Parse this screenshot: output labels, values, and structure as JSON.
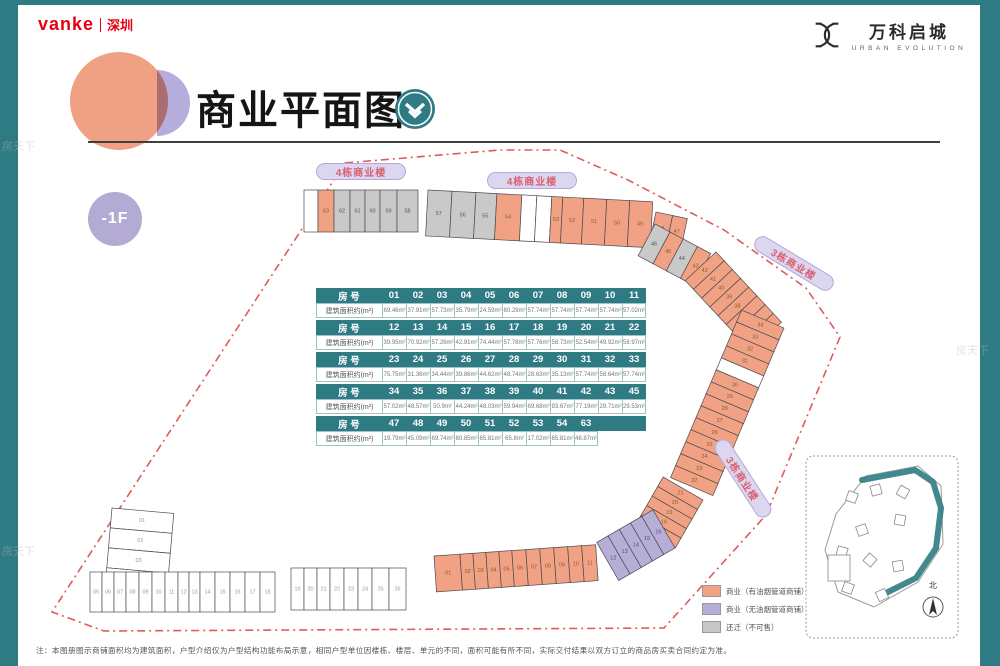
{
  "brand": {
    "name": "vanke",
    "region": "深圳"
  },
  "logo": {
    "title": "万科启城",
    "subtitle": "URBAN EVOLUTION"
  },
  "title": {
    "text": "商业平面图"
  },
  "floor_badge": "-1F",
  "watermark": "房天下",
  "building_labels": {
    "b4": "4栋商业楼",
    "b3": "3栋商业楼"
  },
  "table": {
    "no_label": "房  号",
    "area_label": "建筑面积约(m²)",
    "groups": [
      {
        "nos": [
          "01",
          "02",
          "03",
          "04",
          "05",
          "06",
          "07",
          "08",
          "09",
          "10",
          "11"
        ],
        "areas": [
          "69.46m²",
          "37.91m²",
          "57.73m²",
          "35.79m²",
          "24.59m²",
          "60.29m²",
          "57.74m²",
          "57.74m²",
          "57.74m²",
          "57.74m²",
          "57.02m²"
        ]
      },
      {
        "nos": [
          "12",
          "13",
          "14",
          "15",
          "16",
          "17",
          "18",
          "19",
          "20",
          "21",
          "22"
        ],
        "areas": [
          "39.95m²",
          "70.92m²",
          "57.26m²",
          "42.91m²",
          "74.44m²",
          "57.78m²",
          "57.76m²",
          "58.73m²",
          "52.54m²",
          "49.92m²",
          "58.97m²"
        ]
      },
      {
        "nos": [
          "23",
          "24",
          "25",
          "26",
          "27",
          "28",
          "29",
          "30",
          "31",
          "32",
          "33"
        ],
        "areas": [
          "75.75m²",
          "31.36m²",
          "34.44m²",
          "39.86m²",
          "44.62m²",
          "48.74m²",
          "28.63m²",
          "35.13m²",
          "57.74m²",
          "58.64m²",
          "57.74m²"
        ]
      },
      {
        "nos": [
          "34",
          "35",
          "36",
          "37",
          "38",
          "39",
          "40",
          "41",
          "42",
          "43",
          "45"
        ],
        "areas": [
          "57.02m²",
          "48.57m²",
          "50.9m²",
          "44.24m²",
          "48.03m²",
          "59.94m²",
          "69.68m²",
          "93.67m²",
          "77.19m²",
          "29.71m²",
          "29.53m²"
        ]
      },
      {
        "nos": [
          "47",
          "48",
          "49",
          "50",
          "51",
          "52",
          "53",
          "54",
          "63"
        ],
        "areas": [
          "19.79m²",
          "45.09m²",
          "69.74m²",
          "80.85m²",
          "65.81m²",
          "65.8m²",
          "17.02m²",
          "65.81m²",
          "48.87m²"
        ]
      }
    ]
  },
  "legend": {
    "items": [
      {
        "label": "商业（有油烟管道商铺）",
        "color": "#f2a284"
      },
      {
        "label": "商业（无油烟管道商铺）",
        "color": "#b7aed8"
      },
      {
        "label": "还迁（不可售）",
        "color": "#c7c7c7"
      }
    ]
  },
  "unit_colors": {
    "orange": "#f2a284",
    "gray": "#c9c9c9",
    "purple": "#b7aed8",
    "white": "#ffffff"
  },
  "boundary_color": "#e05a5a",
  "accent_teal": "#2e7b83",
  "inset": {
    "north_label": "北"
  },
  "note": "注：本图册图示商铺面积均为建筑面积，户型介绍仅为户型结构功能布局示意，相同户型单位因楼栋、楼层、单元的不同，面积可能有所不同，实际交付结果以双方订立的商品房买卖合同约定为准。",
  "plan": {
    "strips": {
      "topLeftRow": [
        {
          "no": "",
          "cat": "white"
        },
        {
          "no": "63",
          "cat": "orange"
        },
        {
          "no": "62",
          "cat": "gray"
        },
        {
          "no": "61",
          "cat": "gray"
        },
        {
          "no": "60",
          "cat": "gray"
        },
        {
          "no": "59",
          "cat": "gray"
        },
        {
          "no": "58",
          "cat": "gray"
        }
      ],
      "topMidRow": [
        {
          "no": "57",
          "cat": "gray"
        },
        {
          "no": "56",
          "cat": "gray"
        },
        {
          "no": "55",
          "cat": "gray"
        },
        {
          "no": "54",
          "cat": "orange"
        },
        {
          "no": "",
          "cat": "white"
        },
        {
          "no": "",
          "cat": "white"
        },
        {
          "no": "53",
          "cat": "orange"
        },
        {
          "no": "52",
          "cat": "orange"
        },
        {
          "no": "51",
          "cat": "orange"
        },
        {
          "no": "50",
          "cat": "orange"
        },
        {
          "no": "49",
          "cat": "orange"
        }
      ],
      "topMidRow2": [
        {
          "no": "48",
          "cat": "orange"
        },
        {
          "no": "47",
          "cat": "orange"
        }
      ],
      "rightDiag1": [
        {
          "no": "46",
          "cat": "gray"
        },
        {
          "no": "45",
          "cat": "orange"
        },
        {
          "no": "44",
          "cat": "gray"
        },
        {
          "no": "43",
          "cat": "orange"
        }
      ],
      "rightDiag2": [
        {
          "no": "42",
          "cat": "orange"
        },
        {
          "no": "41",
          "cat": "orange"
        },
        {
          "no": "40",
          "cat": "orange"
        },
        {
          "no": "39",
          "cat": "orange"
        },
        {
          "no": "38",
          "cat": "orange"
        },
        {
          "no": "37",
          "cat": "orange"
        },
        {
          "no": "36",
          "cat": "orange"
        },
        {
          "no": "35",
          "cat": "orange"
        }
      ],
      "rightCol": [
        {
          "no": "34",
          "cat": "orange"
        },
        {
          "no": "33",
          "cat": "orange"
        },
        {
          "no": "32",
          "cat": "orange"
        },
        {
          "no": "31",
          "cat": "orange"
        },
        {
          "no": "",
          "cat": "white"
        },
        {
          "no": "30",
          "cat": "orange"
        },
        {
          "no": "29",
          "cat": "orange"
        },
        {
          "no": "28",
          "cat": "orange"
        },
        {
          "no": "27",
          "cat": "orange"
        },
        {
          "no": "26",
          "cat": "orange"
        },
        {
          "no": "25",
          "cat": "orange"
        },
        {
          "no": "24",
          "cat": "orange"
        },
        {
          "no": "23",
          "cat": "orange"
        },
        {
          "no": "22",
          "cat": "orange"
        }
      ],
      "bottomRightAsc": [
        {
          "no": "21",
          "cat": "orange"
        },
        {
          "no": "20",
          "cat": "orange"
        },
        {
          "no": "19",
          "cat": "orange"
        },
        {
          "no": "18",
          "cat": "orange"
        },
        {
          "no": "17",
          "cat": "orange"
        }
      ],
      "purpleCurve": [
        {
          "no": "16",
          "cat": "purple"
        },
        {
          "no": "15",
          "cat": "purple"
        },
        {
          "no": "14",
          "cat": "purple"
        },
        {
          "no": "13",
          "cat": "purple"
        },
        {
          "no": "12",
          "cat": "purple"
        }
      ],
      "bottomMidRow": [
        {
          "no": "01",
          "cat": "orange"
        },
        {
          "no": "02",
          "cat": "orange"
        },
        {
          "no": "03",
          "cat": "orange"
        },
        {
          "no": "04",
          "cat": "orange"
        },
        {
          "no": "05",
          "cat": "orange"
        },
        {
          "no": "06",
          "cat": "orange"
        },
        {
          "no": "07",
          "cat": "orange"
        },
        {
          "no": "08",
          "cat": "orange"
        },
        {
          "no": "09",
          "cat": "orange"
        },
        {
          "no": "10",
          "cat": "orange"
        },
        {
          "no": "11",
          "cat": "orange"
        }
      ],
      "bottomLeftStack": [
        {
          "no": "01",
          "cat": "white"
        },
        {
          "no": "02",
          "cat": "white"
        },
        {
          "no": "03",
          "cat": "white"
        },
        {
          "no": "04",
          "cat": "white"
        }
      ],
      "bottomLeftRow1": [
        {
          "no": "05",
          "cat": "white"
        },
        {
          "no": "06",
          "cat": "white"
        },
        {
          "no": "07",
          "cat": "white"
        },
        {
          "no": "08",
          "cat": "white"
        },
        {
          "no": "09",
          "cat": "white"
        },
        {
          "no": "10",
          "cat": "white"
        },
        {
          "no": "11",
          "cat": "white"
        },
        {
          "no": "12",
          "cat": "white"
        },
        {
          "no": "13",
          "cat": "white"
        },
        {
          "no": "14",
          "cat": "white"
        },
        {
          "no": "15",
          "cat": "white"
        },
        {
          "no": "16",
          "cat": "white"
        },
        {
          "no": "17",
          "cat": "white"
        },
        {
          "no": "18",
          "cat": "white"
        }
      ],
      "bottomLeftRow2": [
        {
          "no": "19",
          "cat": "white"
        },
        {
          "no": "20",
          "cat": "white"
        },
        {
          "no": "21",
          "cat": "white"
        },
        {
          "no": "22",
          "cat": "white"
        },
        {
          "no": "23",
          "cat": "white"
        },
        {
          "no": "24",
          "cat": "white"
        },
        {
          "no": "25",
          "cat": "white"
        },
        {
          "no": "26",
          "cat": "white"
        }
      ]
    }
  }
}
